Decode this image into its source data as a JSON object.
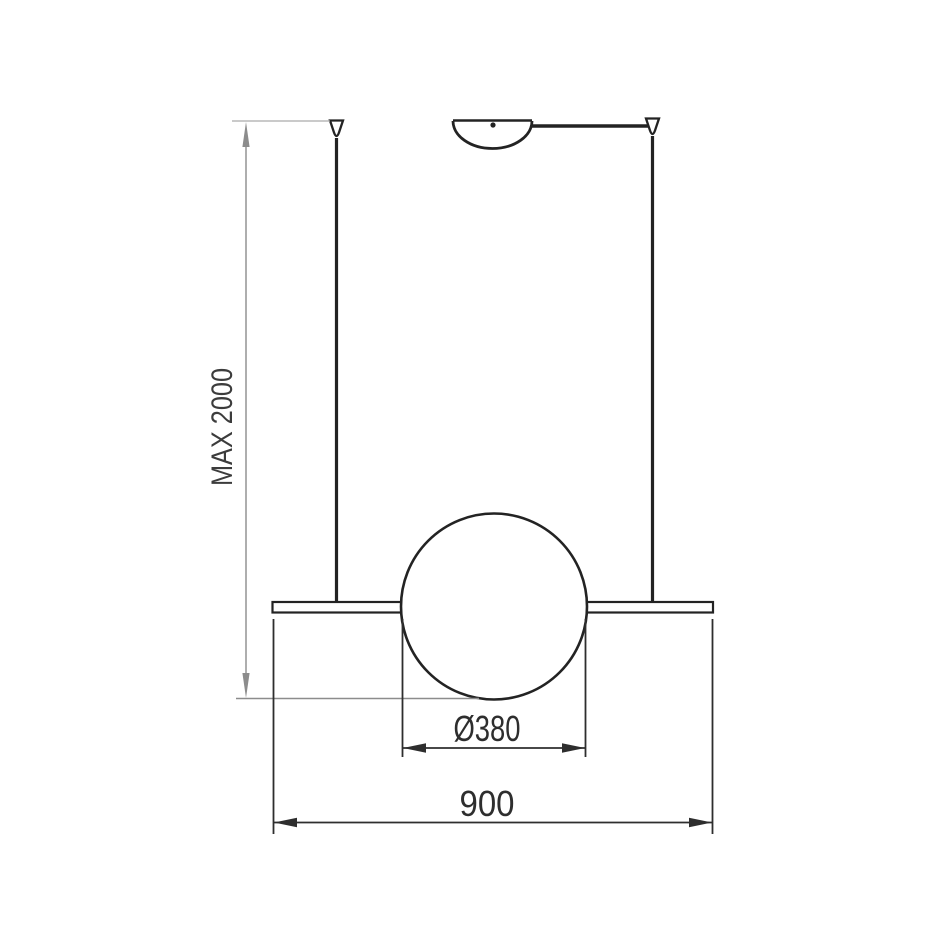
{
  "diagram": {
    "type": "pendant-lamp-dimension-drawing",
    "colors": {
      "background": "#ffffff",
      "outline": "#232323",
      "dimension": "#2e2e2e",
      "dimension_gray": "#8c8c8c",
      "label_text": "#3c3c3c"
    },
    "dimensions": {
      "max_drop": {
        "label": "MAX 2000",
        "orientation": "vertical"
      },
      "sphere_diameter": {
        "label": "Ø380",
        "orientation": "horizontal"
      },
      "bar_length": {
        "label": "900",
        "orientation": "horizontal"
      }
    }
  }
}
